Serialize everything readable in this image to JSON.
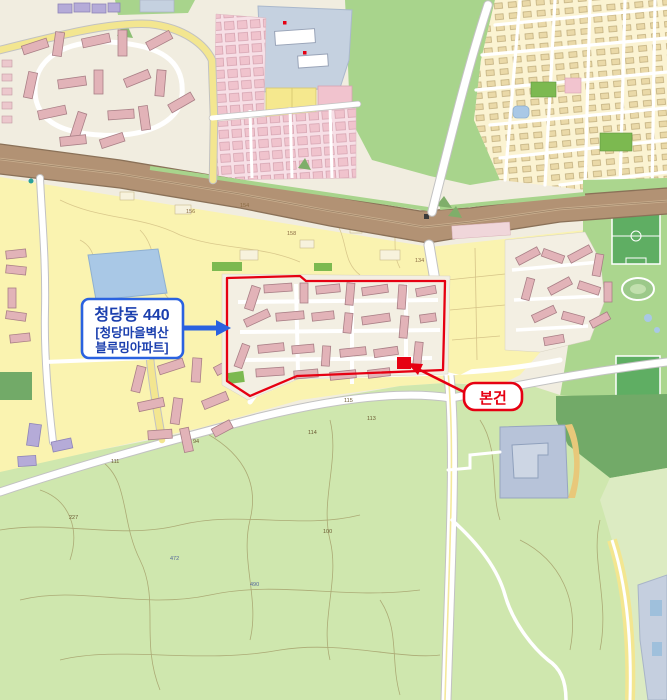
{
  "callout": {
    "line1": "청당동 440",
    "line2": "[청당마을벽산",
    "line3": "블루밍아파트]"
  },
  "subject": {
    "label": "본건"
  },
  "colors": {
    "red": "#e60012",
    "blue": "#2a62e0",
    "blue_text": "#1b3fae",
    "urban_base": "#f1ede0",
    "yellow_zone": "#faf3b0",
    "building_pink": "#e2b3b8",
    "building_purple": "#b5abd8",
    "water": "#a9c8e6",
    "park_green": "#abd68e",
    "hill_green": "#a8d48c",
    "forest_green": "#cfe7ae",
    "dark_forest": "#72aa68",
    "field_green": "#5fae63",
    "road_major": "#b29274",
    "facility_blue": "#c5d1e0"
  },
  "parcel_labels": [
    {
      "text": "154",
      "x": 240,
      "y": 207,
      "c": "#8a6b43"
    },
    {
      "text": "156",
      "x": 186,
      "y": 213,
      "c": "#8a6b43"
    },
    {
      "text": "158",
      "x": 287,
      "y": 235,
      "c": "#8a6b43"
    },
    {
      "text": "134",
      "x": 415,
      "y": 262,
      "c": "#8a6b43"
    },
    {
      "text": "115",
      "x": 344,
      "y": 402,
      "c": "#6b5b33"
    },
    {
      "text": "113",
      "x": 367,
      "y": 420,
      "c": "#6b5b33"
    },
    {
      "text": "114",
      "x": 308,
      "y": 434,
      "c": "#6b5b33"
    },
    {
      "text": "94",
      "x": 193,
      "y": 443,
      "c": "#6b5b33"
    },
    {
      "text": "111",
      "x": 111,
      "y": 463,
      "c": "#6b5b33"
    },
    {
      "text": "227",
      "x": 69,
      "y": 519,
      "c": "#6b5b33"
    },
    {
      "text": "100",
      "x": 323,
      "y": 533,
      "c": "#6b5b33"
    },
    {
      "text": "472",
      "x": 170,
      "y": 560,
      "c": "#55679a"
    },
    {
      "text": "490",
      "x": 250,
      "y": 586,
      "c": "#55679a"
    }
  ]
}
